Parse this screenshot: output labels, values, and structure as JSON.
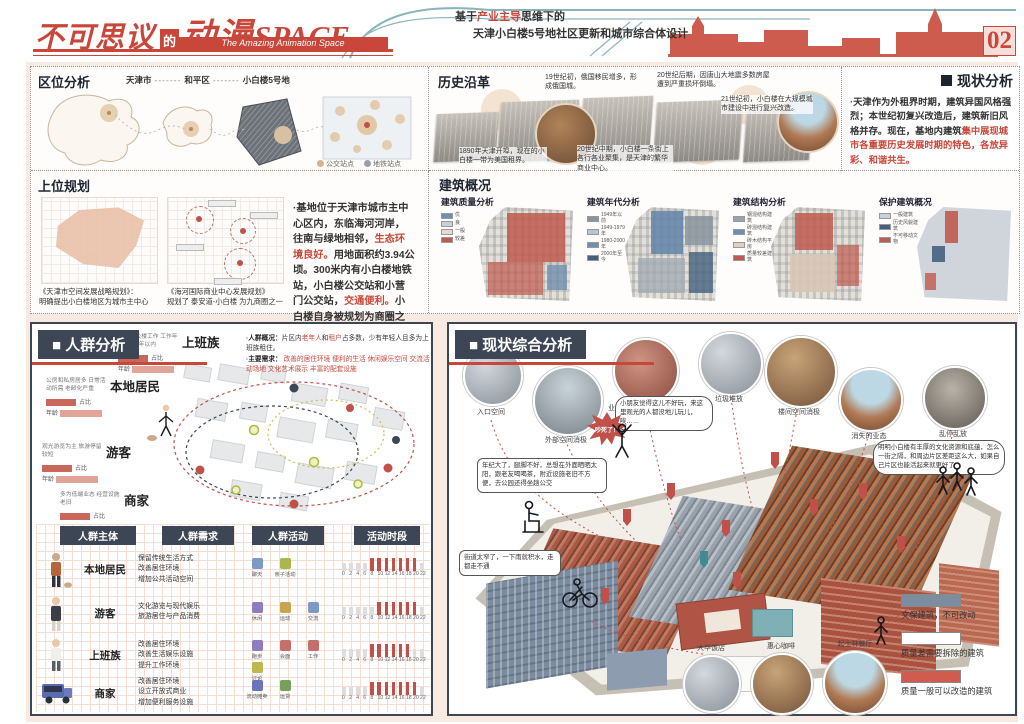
{
  "page": {
    "number": "02"
  },
  "header": {
    "title_main": "不可思议",
    "title_de": "的",
    "title_anime": "动漫",
    "title_space": "SPACE",
    "subtitle": "The Amazing Animation Space",
    "tagline_prefix": "基于",
    "tagline_highlight": "产业主导",
    "tagline_suffix": "思维下的",
    "tagline_line2": "天津小白楼5号地社区更新和城市综合体设计"
  },
  "location": {
    "title": "区位分析",
    "crumbs": [
      "天津市",
      "和平区",
      "小白楼5号地"
    ],
    "dash": "-------",
    "legend": [
      {
        "label": "公交站点",
        "color": "#d8b28a"
      },
      {
        "label": "地铁站点",
        "color": "#9aa0a8"
      }
    ]
  },
  "planning": {
    "title": "上位规划",
    "caption1_title": "《天津市空间发展战略规划》：",
    "caption1_text": "明确提出小白楼地区为城市主中心",
    "caption2_title": "《海河国际商业中心发展规划》",
    "caption2_text": "规划了 泰安道-小白楼 为九商圈之一",
    "p1": "·基地位于天津市城市主中心区内，东临海河河岸，往南与绿地相邻，",
    "r1": "生态环境良好。",
    "p2": "用地面积约3.94公顷。300米内有小白楼地铁站，小白楼公交站和小营门公交站，",
    "r2": "交通便利。",
    "p3": "小白楼自身被规划为商圈之一，且毗邻多个商圈，具有",
    "r3": "优越的商业条件。"
  },
  "history": {
    "title": "历史沿革",
    "notes": [
      "19世纪初，俄国移民增多，形成俄国城。",
      "20世纪后期，因唐山大地震多数房屋遭到严重损坏倒塌。",
      "21世纪初，小白楼在大规模城市建设中进行复兴改造。",
      "1890年天津开埠，现在的小白楼一带为美国租界。",
      "20世纪中期，小白楼一条街上各行各业聚集，是天津的繁华商业中心。"
    ]
  },
  "status": {
    "title": "现状分析",
    "p1": "·天津作为外租界时期，建筑异国风格强烈；本世纪初复兴改造后，建筑新旧风格并存。现在，基地内建筑",
    "r1": "集中展现城市各重要历史发展时期的特色，各放异彩、和谐共生。"
  },
  "buildings": {
    "title": "建筑概况",
    "maps": [
      {
        "title": "建筑质量分析",
        "legend": [
          {
            "c": "#6f8fae",
            "t": "优"
          },
          {
            "c": "#c9cfd6",
            "t": "良"
          },
          {
            "c": "#e8d9c9",
            "t": "一般"
          },
          {
            "c": "#bf5a4e",
            "t": "较差"
          }
        ]
      },
      {
        "title": "建筑年代分析",
        "legend": [
          {
            "c": "#8a949e",
            "t": "1949年以前"
          },
          {
            "c": "#b9c6d2",
            "t": "1949-1979年"
          },
          {
            "c": "#6f8fae",
            "t": "1980-2000年"
          },
          {
            "c": "#45617e",
            "t": "2000年至今"
          }
        ]
      },
      {
        "title": "建筑结构分析",
        "legend": [
          {
            "c": "#9aa4ae",
            "t": "钢混结构建筑"
          },
          {
            "c": "#6f8fae",
            "t": "砖混结构建筑"
          },
          {
            "c": "#e3cfc0",
            "t": "砖木结构平房"
          },
          {
            "c": "#bf5a4e",
            "t": "质量较差建筑"
          }
        ]
      },
      {
        "title": "保护建筑概况",
        "legend": [
          {
            "c": "#c9cfd6",
            "t": "一般建筑"
          },
          {
            "c": "#45617e",
            "t": "历史风貌建筑"
          },
          {
            "c": "#bf5a4e",
            "t": "不可移动文物"
          }
        ]
      }
    ]
  },
  "crowd": {
    "title": "人群分析",
    "overview_label": "·人群概况：",
    "overview_a": "片区内",
    "overview_r1": "老年人",
    "overview_b": "和",
    "overview_r2": "租户",
    "overview_c": "占多数，少有年轻人且多为上班族租住。",
    "needs_label": "·主要需求：",
    "needs": [
      "改善的居住环境",
      "便利的生活",
      "休闲娱乐空间",
      "交流活动场地",
      "文化艺术展示",
      "丰富的配套设施"
    ],
    "personas": [
      {
        "name": "本地居民",
        "note": "公房和私房居多 日常活动所需 老龄化严重",
        "stat1": "占比",
        "stat2": "年龄"
      },
      {
        "name": "游客",
        "note": "观光游览为主 旅游停留较短",
        "stat1": "占比",
        "stat2": "年龄"
      },
      {
        "name": "商家",
        "note": "多为低端业态 经营设施老旧",
        "stat1": "占比",
        "stat2": "年龄"
      },
      {
        "name": "上班族",
        "note": "附近办公楼工作 工作年限多为5年以内",
        "stat1": "占比",
        "stat2": "年龄"
      }
    ],
    "table": {
      "headers": [
        "人群主体",
        "人群需求",
        "人群活动",
        "活动时段"
      ],
      "time_ticks": [
        "0",
        "2",
        "4",
        "6",
        "8",
        "10",
        "12",
        "14",
        "16",
        "18",
        "20",
        "22"
      ],
      "rows": [
        {
          "subject": "本地居民",
          "needs": [
            "保留传统生活方式",
            "改善居住环境",
            "增加公共活动空间"
          ],
          "acts": [
            "聊天",
            "亲子活动"
          ],
          "bars": [
            0,
            0,
            0,
            0,
            1,
            1,
            1,
            1,
            1,
            1,
            1,
            0
          ]
        },
        {
          "subject": "游客",
          "needs": [
            "文化游览与现代娱乐",
            "旅游居住与产品消费"
          ],
          "acts": [
            "休闲",
            "运动",
            "交流"
          ],
          "bars": [
            0,
            0,
            0,
            0,
            0,
            1,
            1,
            1,
            1,
            1,
            1,
            0
          ]
        },
        {
          "subject": "上班族",
          "needs": [
            "改善居住环境",
            "改善生活娱乐设施",
            "提升工作环境"
          ],
          "acts": [
            "跑步",
            "会面",
            "工作",
            "讨论"
          ],
          "bars": [
            0,
            0,
            0,
            0,
            1,
            1,
            1,
            1,
            1,
            1,
            0,
            0
          ]
        },
        {
          "subject": "商家",
          "needs": [
            "改善居住环境",
            "设立开放式商业",
            "增加便利服务设施"
          ],
          "acts": [
            "流动摊卖",
            "运货"
          ],
          "bars": [
            0,
            0,
            0,
            0,
            1,
            1,
            1,
            1,
            1,
            1,
            1,
            0
          ]
        }
      ]
    }
  },
  "comprehensive": {
    "title": "现状综合分析",
    "issues": [
      "入口空间",
      "外部空间消极",
      "业态低端 产业结构单一",
      "垃圾堆放",
      "楼间空间消极",
      "消失的业态",
      "乱停乱放"
    ],
    "bubbles": {
      "b1": "年纪大了，腿脚不好，总想在外面晒晒太阳，跟老友喝喝茶，附近设施老旧不方便，去公园还得坐趟公交",
      "b2": "小朋友觉得这儿不好玩，来这里观光的人都没地儿玩儿，唉……",
      "b3": "街道太窄了，一下雨就积水，走都走不通",
      "b4": "明明小白楼有丰厚的文化资源和底蕴，怎么一街之隔，和周边片区差距这么大，如果自己片区也能活起来就更好了",
      "shout": "吵死了！"
    },
    "landmarks": [
      "大华饭店",
      "惠心咖啡",
      "起士林餐厅"
    ],
    "legend": [
      {
        "color": "#7d8da0",
        "label": "文保建筑，不可改动"
      },
      {
        "color": "#ffffff",
        "label": "质量差需要拆除的建筑"
      },
      {
        "color": "#d05c50",
        "label": "质量一般可以改造的建筑"
      }
    ]
  }
}
